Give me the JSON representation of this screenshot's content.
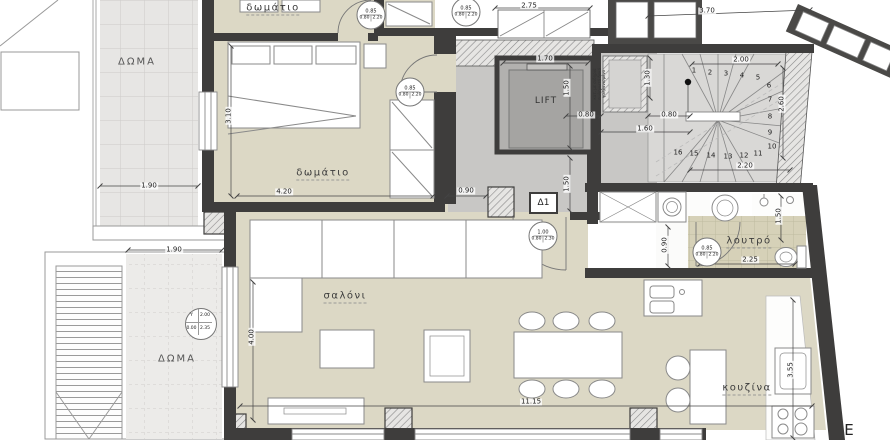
{
  "plan_title": "apartment floor plan",
  "colors": {
    "wall": "#3e3d3c",
    "floor_beige": "#dcd8c5",
    "hall_grey": "#c8c7c5",
    "stair_grey": "#d9d8d6",
    "bath_tile": "#d6d1b8",
    "outdoor_tile": "#e7e6e4",
    "lift_shaft": "#b2b1af",
    "glazing_frame": "#4a4947"
  },
  "rooms": {
    "bedroom_top": "δωμάτιο",
    "bedroom": "δωμάτιο",
    "living": "σαλόνι",
    "kitchen": "κουζίνα",
    "bath": "λουτρό",
    "lift": "LIFT",
    "roof_upper": "ΔΩΜΑ",
    "roof_lower": "ΔΩΜΑ",
    "door_tag": "Δ1",
    "east_mark": "E"
  },
  "dims": {
    "d190a": "1.90",
    "d190b": "1.90",
    "d310": "3.10",
    "d420": "4.20",
    "d090a": "0.90",
    "d400": "4.00",
    "d1115": "11.15",
    "d275": "2.75",
    "d370": "3.70",
    "d170": "1.70",
    "d150_lift": "1.50",
    "d080a": "0.80",
    "d080b": "0.80",
    "d160": "1.60",
    "d130": "1.30",
    "d200": "2.00",
    "d220": "2.20",
    "d260": "2.60",
    "d150_hall": "1.50",
    "d090_bath": "0.90",
    "d225": "2.25",
    "d150_bath": "1.50",
    "d355": "3.55"
  },
  "stairs": {
    "numbers": [
      "1",
      "2",
      "3",
      "4",
      "5",
      "6",
      "7",
      "8",
      "9",
      "10",
      "11",
      "12",
      "13",
      "14",
      "15",
      "16"
    ]
  },
  "markers": [
    {
      "size": "0.85",
      "clear": "0.80",
      "height": "2.20"
    },
    {
      "size": "0.85",
      "clear": "0.80",
      "height": "2.20"
    },
    {
      "size": "0.85",
      "clear": "0.80",
      "height": "2.20"
    },
    {
      "size": "1.00",
      "clear": "0.80",
      "height": "2.30"
    },
    {
      "size": "0.85",
      "clear": "0.80",
      "height": "2.20"
    }
  ],
  "window_marker": {
    "q1": "Y",
    "q2": "2.00",
    "q3": "0.00",
    "q4": "2.35"
  },
  "note": {
    "l1": "κατ. με σιδηριά",
    "l2": "σωληνωτό δοκό",
    "l3": "γαλβανισμένο"
  }
}
